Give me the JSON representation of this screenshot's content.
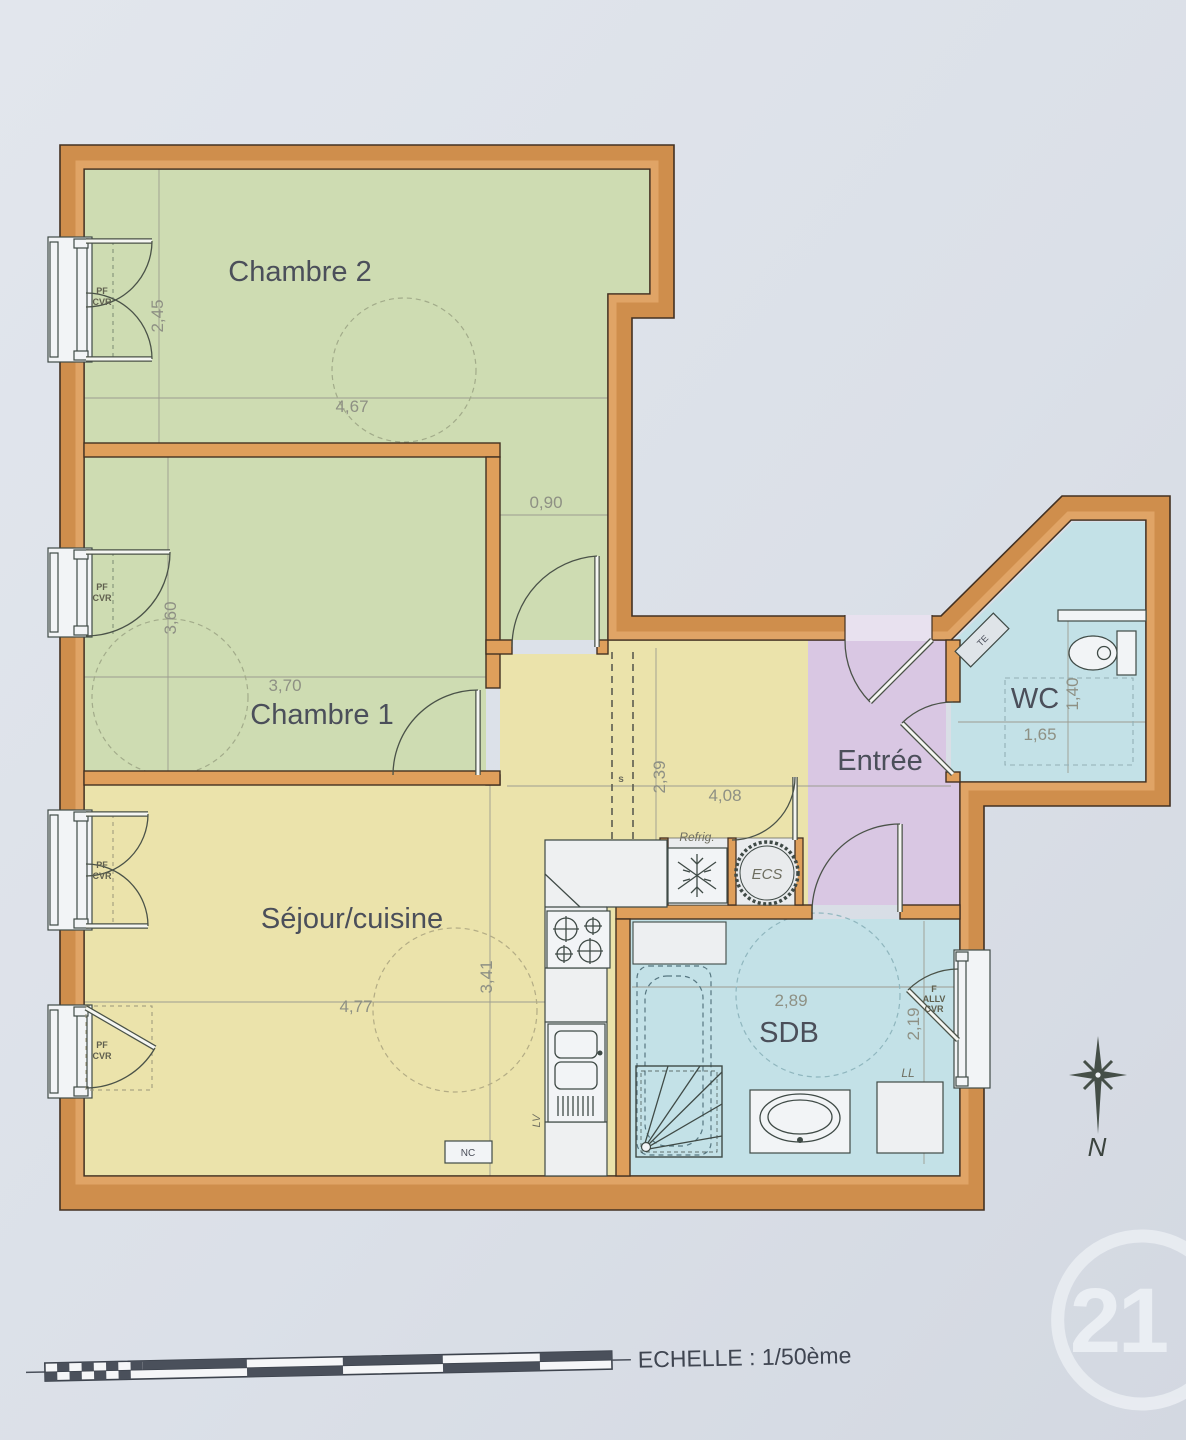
{
  "plan": {
    "rooms": {
      "chambre2": {
        "name": "Chambre 2",
        "dim_width": "4,67",
        "dim_height": "2,45",
        "dim_passage": "0,90"
      },
      "chambre1": {
        "name": "Chambre 1",
        "dim_width": "3,70",
        "dim_height": "3,60"
      },
      "sejour_cuisine": {
        "name": "Séjour/cuisine",
        "dim_width": "4,77",
        "dim_height": "3,41"
      },
      "couloir": {
        "dim_width": "4,08",
        "dim_height": "2,39",
        "soffit_label": "s"
      },
      "entree": {
        "name": "Entrée"
      },
      "wc": {
        "name": "WC",
        "dim_width": "1,65",
        "dim_height": "1,40",
        "electrical_panel_label": "TE"
      },
      "sdb": {
        "name": "SDB",
        "dim_width": "2,89",
        "dim_height": "2,19"
      }
    },
    "equipment_labels": {
      "refrigerator": "Refrig.",
      "water_heater": "ECS",
      "dishwasher": "LV",
      "washing_machine": "LL",
      "nc_box": "NC"
    },
    "window_labels": {
      "pf": "PF",
      "cvr": "CVR",
      "f": "F",
      "allv": "ALLV"
    },
    "colors": {
      "wall_outer": "#cf8e4c",
      "wall_inner_band": "#e0a466",
      "bedroom_floor": "#cedcb2",
      "living_floor": "#ebe3ab",
      "entry_floor": "#d9c7e3",
      "bath_floor": "#c3e1e7",
      "background": "#dbe0e8"
    }
  },
  "footer": {
    "scale_text": "ECHELLE : 1/50ème"
  },
  "compass": {
    "north_label": "N"
  },
  "watermark": {
    "logo_number": "21"
  }
}
